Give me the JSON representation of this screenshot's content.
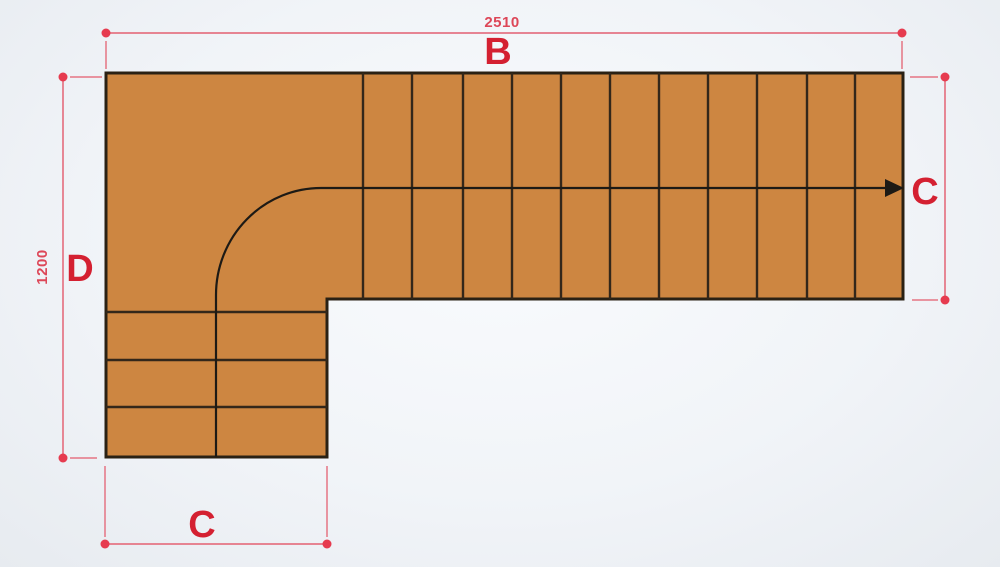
{
  "labels": {
    "top_dimension": "2510",
    "top_letter": "B",
    "left_dimension": "1200",
    "left_letter": "D",
    "bottom_letter": "C",
    "exit_letter": "C"
  },
  "colors": {
    "background": "#f1f4f8",
    "tread_fill": "#cd8641",
    "tread_line": "#33271a",
    "outline": "#2a2114",
    "walking_line": "#1d1a15",
    "dim_line": "#e57484",
    "dim_dot": "#e63b4f",
    "dim_text": "#dd4758",
    "letter_text": "#d42031"
  },
  "stairs": {
    "type": "L-shaped staircase plan view",
    "right_flight_tread_x": [
      363,
      412,
      463,
      512,
      561,
      610,
      659,
      708,
      757,
      807,
      855
    ],
    "right_flight_top": 73,
    "right_flight_bottom": 299,
    "right_flight_tread_count": 11,
    "bottom_flight_tread_y": [
      312,
      360,
      407
    ],
    "bottom_flight_left": 106,
    "bottom_flight_right": 327,
    "bottom_flight_tread_count": 3
  }
}
